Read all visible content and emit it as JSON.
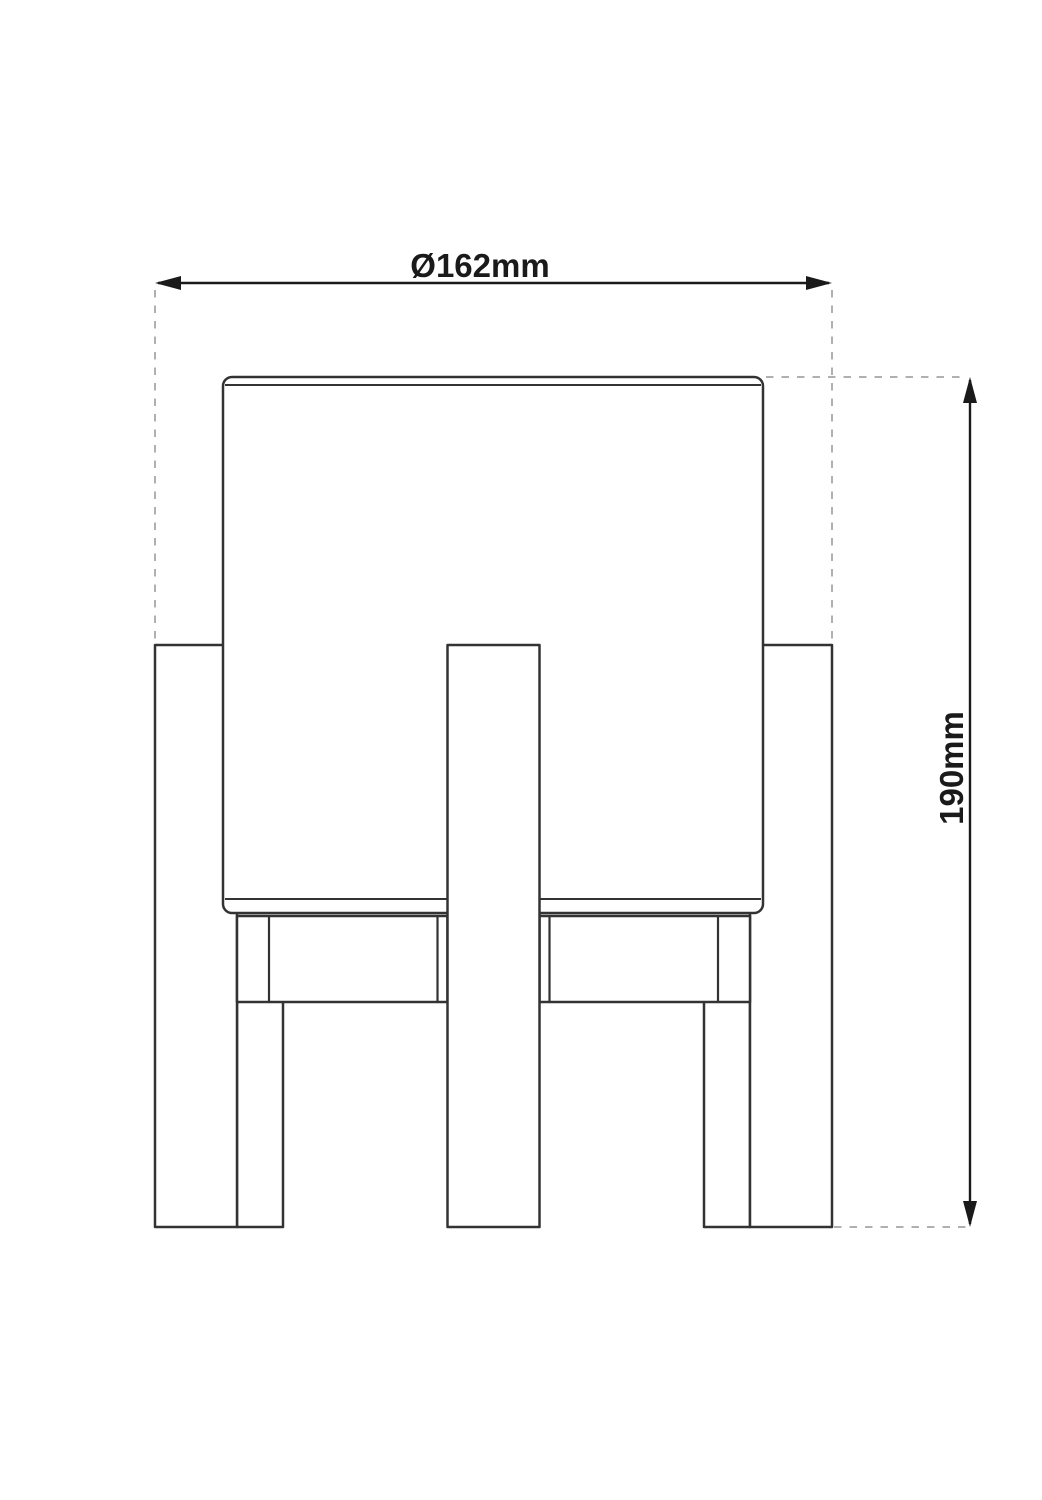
{
  "colors": {
    "background": "#ffffff",
    "object_line": "#333333",
    "dimension_line": "#1a1a1a",
    "extension_dash": "#b0b0b0",
    "text": "#1a1a1a"
  },
  "dimensions": {
    "diameter": {
      "label": "Ø162mm"
    },
    "height": {
      "label": "190mm"
    }
  }
}
